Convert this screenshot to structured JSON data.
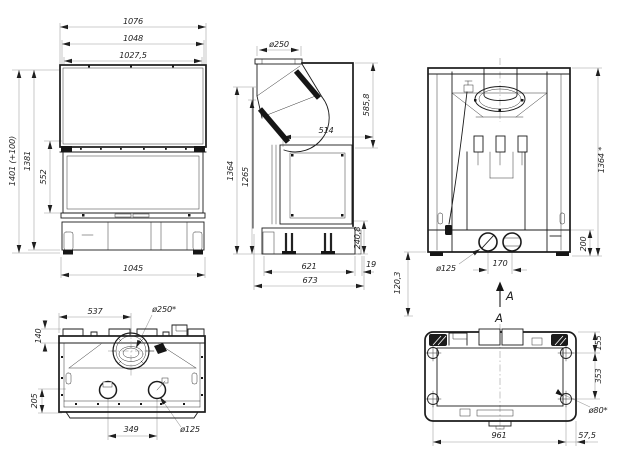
{
  "sheet": {
    "background": "#ffffff",
    "line_color": "#1b1b1b",
    "dim_line_color": "#9a9a9a",
    "text_color": "#1f1f1f"
  },
  "front_view": {
    "dim_width_overall": "1076",
    "dim_width_frame": "1048",
    "dim_width_glass": "1027,5",
    "dim_height_overall": "1401 (+100)",
    "dim_height_body": "1381",
    "dim_height_glass": "552",
    "dim_width_base": "1045"
  },
  "side_view": {
    "dim_flue_diameter": "ø250",
    "dim_hood_height": "585,8",
    "dim_depth_glass": "514",
    "dim_height_overall": "1364",
    "dim_height_body": "1265",
    "dim_height_base": "240,8",
    "dim_rear_gap": "19",
    "dim_depth_base": "621",
    "dim_depth_overall": "673"
  },
  "rear_view": {
    "dim_height_overall": "1364 *",
    "dim_plinth_height": "200",
    "dim_lower_offset": "120,3",
    "dim_inlet_diameter": "ø125",
    "dim_inlet_spacing": "170",
    "section_arrow_label": "A"
  },
  "top_view": {
    "dim_flue_center_from_left": "537",
    "dim_flue_diameter": "ø250*",
    "dim_rear_ledge": "140",
    "dim_front_depth": "205",
    "dim_inlet_spacing": "349",
    "dim_inlet_diameter": "ø125"
  },
  "bottom_view": {
    "view_label": "A",
    "dim_rear_offset": "155",
    "dim_hole_spacing": "353",
    "dim_hole_diameter": "ø80*",
    "dim_width_holes": "961",
    "dim_side_offset": "57,5"
  }
}
